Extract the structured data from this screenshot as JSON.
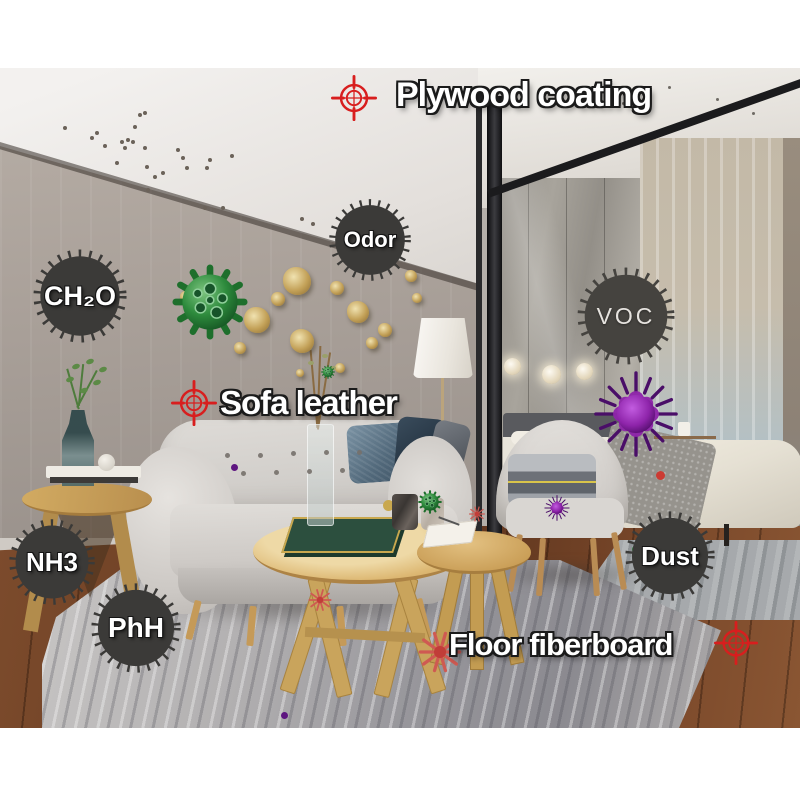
{
  "meta": {
    "description": "Living room product photo annotated with indoor air pollution sources"
  },
  "colors": {
    "crosshair_red": "#d81e1e",
    "badge_dark": "#3b3a38",
    "badge_voc": "#45433f",
    "label_text": "#ffffff",
    "label_outline": "#1b1b1b",
    "virus_green": "#2e8b3d",
    "virus_purple": "#8e24aa",
    "particle_red": "#cc4a44"
  },
  "callouts": {
    "plywood": {
      "label": "Plywood coating",
      "icon": "crosshair-target"
    },
    "sofa": {
      "label": "Sofa leather",
      "icon": "crosshair-target"
    },
    "floor": {
      "label": "Floor fiberboard",
      "icon": "crosshair-target"
    }
  },
  "badges": {
    "odor": {
      "label": "Odor"
    },
    "ch2o": {
      "label": "CH₂O"
    },
    "voc": {
      "label": "VOC"
    },
    "nh3": {
      "label": "NH3"
    },
    "phh": {
      "label": "PhH"
    },
    "dust": {
      "label": "Dust"
    }
  }
}
